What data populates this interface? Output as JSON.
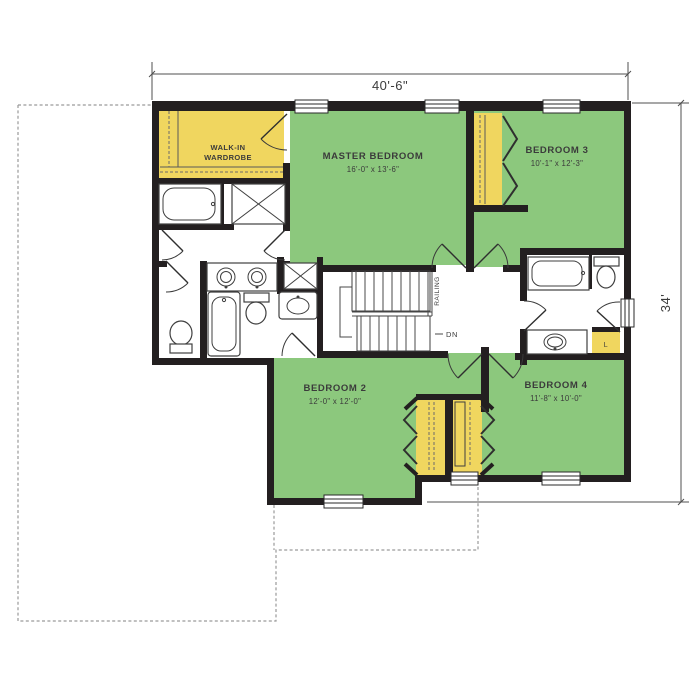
{
  "dimensions": {
    "width": "40'-6\"",
    "height": "34'"
  },
  "rooms": {
    "wardrobe": {
      "line1": "WALK-IN",
      "line2": "WARDROBE"
    },
    "master": {
      "name": "MASTER BEDROOM",
      "size": "16'-0\" x 13'-6\""
    },
    "bedroom3": {
      "name": "BEDROOM 3",
      "size": "10'-1\" x 12'-3\""
    },
    "bedroom2": {
      "name": "BEDROOM 2",
      "size": "12'-0\" x 12'-0\""
    },
    "bedroom4": {
      "name": "BEDROOM 4",
      "size": "11'-8\" x 10'-0\""
    }
  },
  "stairs": {
    "railing": "RAILING",
    "down": "DN"
  },
  "closets": {
    "linen": "L"
  },
  "colors": {
    "room_green": "#8cc87d",
    "closet_yellow": "#f0d65f",
    "wall": "#231f20",
    "line": "#3f3f3f",
    "dash": "#9a9a9a",
    "dim": "#4f4f4f",
    "label": "#3b3b3b"
  }
}
